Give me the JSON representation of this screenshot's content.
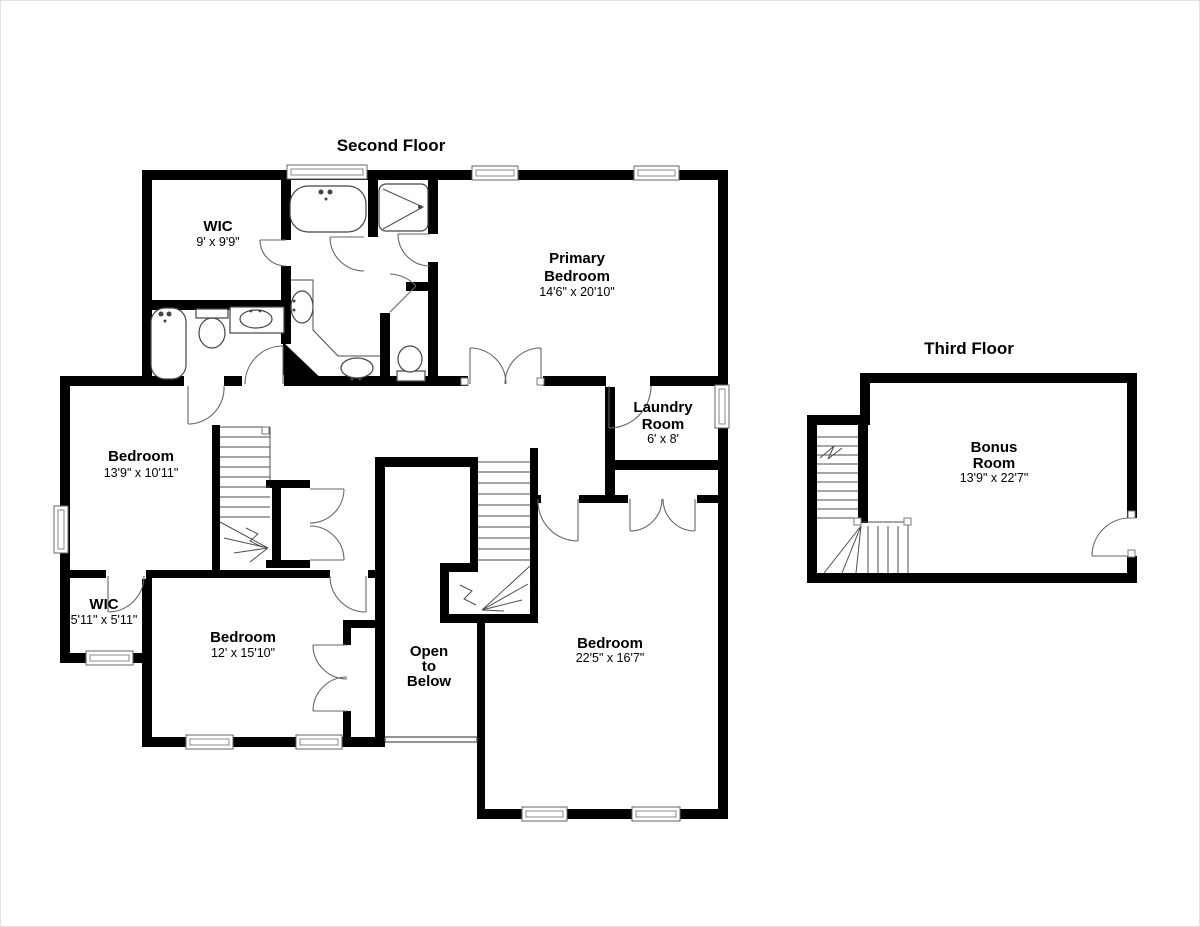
{
  "meta": {
    "background": "#ffffff",
    "wall_color": "#000000",
    "detail_line_color": "#555555",
    "text_color": "#000000"
  },
  "floors": [
    {
      "title": "Second Floor",
      "rooms": [
        {
          "id": "wic-upper",
          "name_lines": [
            "WIC"
          ],
          "dims": "9' x 9'9\""
        },
        {
          "id": "primary-bedroom",
          "name_lines": [
            "Primary",
            "Bedroom"
          ],
          "dims": "14'6\" x 20'10\""
        },
        {
          "id": "laundry-room",
          "name_lines": [
            "Laundry",
            "Room"
          ],
          "dims": "6' x 8'"
        },
        {
          "id": "bedroom-left",
          "name_lines": [
            "Bedroom"
          ],
          "dims": "13'9\" x 10'11\""
        },
        {
          "id": "wic-lower",
          "name_lines": [
            "WIC"
          ],
          "dims": "5'11\" x 5'11\""
        },
        {
          "id": "bedroom-middle",
          "name_lines": [
            "Bedroom"
          ],
          "dims": "12' x 15'10\""
        },
        {
          "id": "open-to-below",
          "name_lines": [
            "Open",
            "to",
            "Below"
          ],
          "dims": ""
        },
        {
          "id": "bedroom-right",
          "name_lines": [
            "Bedroom"
          ],
          "dims": "22'5\" x 16'7\""
        }
      ]
    },
    {
      "title": "Third Floor",
      "rooms": [
        {
          "id": "bonus-room",
          "name_lines": [
            "Bonus",
            "Room"
          ],
          "dims": "13'9\" x 22'7\""
        }
      ]
    }
  ],
  "fixtures": [
    "bathtub",
    "shower",
    "toilet",
    "sink",
    "vanity-counter",
    "staircase",
    "window",
    "door",
    "railing"
  ]
}
